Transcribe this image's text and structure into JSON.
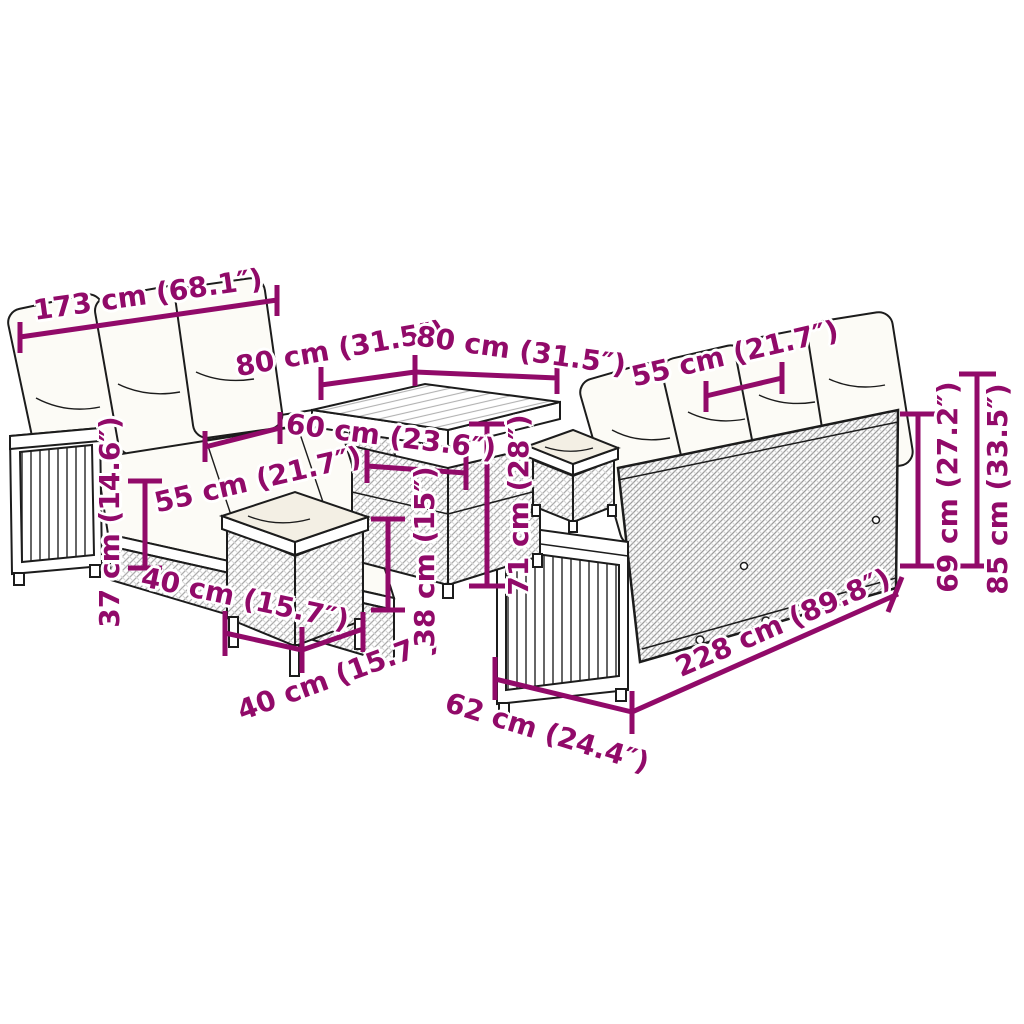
{
  "page": {
    "type": "product-dimension-diagram",
    "background": "#ffffff",
    "accent_color": "#910A69",
    "items": [
      "small 3-seat sofa",
      "square table",
      "front stool",
      "side stool",
      "large 4-seat sofa"
    ]
  },
  "dimensions": {
    "sofa_small_width": "173 cm (68.1″)",
    "table_top_depth": "80 cm (31.5″)",
    "table_top_width": "80 cm (31.5″)",
    "sofa_large_seat_width": "55 cm (21.7″)",
    "table_inner_width": "60 cm (23.6″)",
    "sofa_small_seat_depth": "55 cm (21.7″)",
    "sofa_small_seat_height": "37 cm (14.6″)",
    "stool_depth": "40 cm (15.7″)",
    "stool_width": "40 cm (15.7″)",
    "stool_height": "38 cm (15″)",
    "table_height": "71 cm (28″)",
    "sofa_large_back_height": "69 cm (27.2″)",
    "sofa_large_total_height": "85 cm (33.5″)",
    "sofa_large_width": "228 cm (89.8″)",
    "sofa_large_depth": "62 cm (24.4″)"
  }
}
